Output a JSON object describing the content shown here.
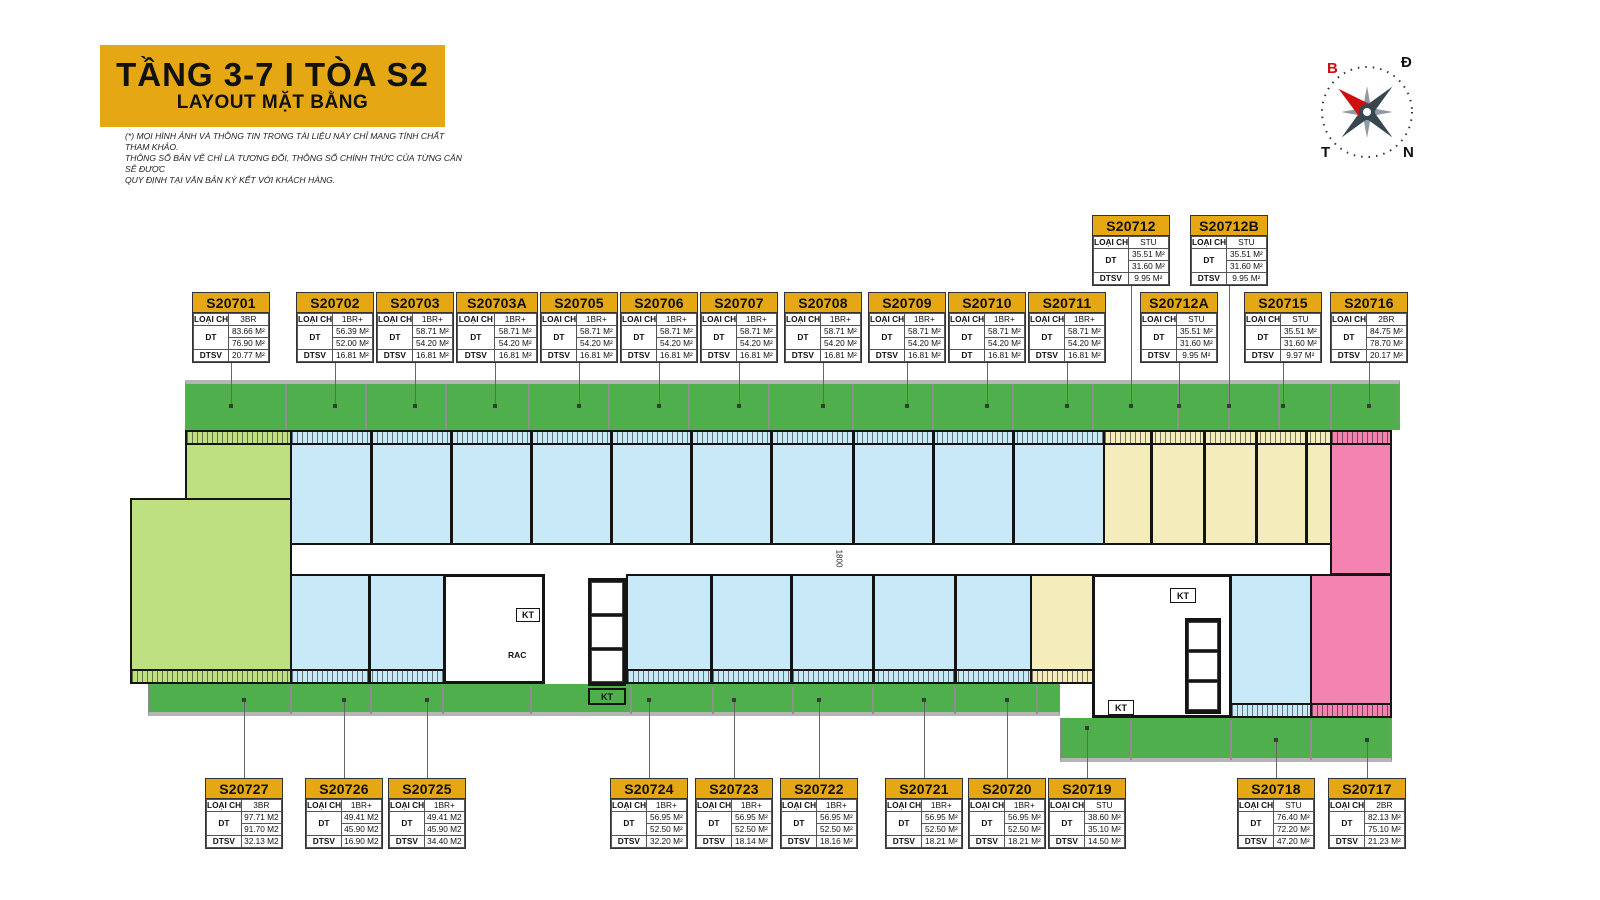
{
  "header": {
    "title_line1": "TẦNG  3-7  I  TÒA S2",
    "title_line2": "LAYOUT MẶT BẰNG",
    "disclaimer_lines": [
      "(*) MỌI HÌNH ẢNH VÀ THÔNG TIN TRONG TÀI LIỆU NÀY CHỈ MANG TÍNH  CHẤT THAM KHẢO.",
      "THÔNG SỐ BẢN VẼ CHỈ LÀ TƯƠNG ĐỐI, THÔNG SỐ CHÍNH THỨC CỦA TỪNG CĂN SẼ ĐƯỢC",
      "QUY ĐỊNH TẠI VĂN BẢN KÝ KẾT VỚI KHÁCH HÀNG."
    ]
  },
  "compass": {
    "north": "B",
    "east": "Đ",
    "west": "T",
    "south": "N"
  },
  "card_labels": {
    "type": "LOẠI CH",
    "area": "DT"
  },
  "units": [
    {
      "code": "S20701",
      "row": "top",
      "type": "3BR",
      "dt1": "83.66 M²",
      "dt2": "76.90 M²",
      "last_label": "DTSV",
      "last_value": "20.77 M²"
    },
    {
      "code": "S20702",
      "row": "top",
      "type": "1BR+",
      "dt1": "56.39 M²",
      "dt2": "52.00 M²",
      "last_label": "DTSV",
      "last_value": "16.81 M²"
    },
    {
      "code": "S20703",
      "row": "top",
      "type": "1BR+",
      "dt1": "58.71 M²",
      "dt2": "54.20 M²",
      "last_label": "DTSV",
      "last_value": "16.81 M²"
    },
    {
      "code": "S20703A",
      "row": "top",
      "type": "1BR+",
      "dt1": "58.71 M²",
      "dt2": "54.20 M²",
      "last_label": "DTSV",
      "last_value": "16.81 M²"
    },
    {
      "code": "S20705",
      "row": "top",
      "type": "1BR+",
      "dt1": "58.71 M²",
      "dt2": "54.20 M²",
      "last_label": "DTSV",
      "last_value": "16.81 M²"
    },
    {
      "code": "S20706",
      "row": "top",
      "type": "1BR+",
      "dt1": "58.71 M²",
      "dt2": "54.20 M²",
      "last_label": "DTSV",
      "last_value": "16.81 M²"
    },
    {
      "code": "S20707",
      "row": "top",
      "type": "1BR+",
      "dt1": "58.71 M²",
      "dt2": "54.20 M²",
      "last_label": "DTSV",
      "last_value": "16.81 M²"
    },
    {
      "code": "S20708",
      "row": "top",
      "type": "1BR+",
      "dt1": "58.71 M²",
      "dt2": "54.20 M²",
      "last_label": "DTSV",
      "last_value": "16.81 M²"
    },
    {
      "code": "S20709",
      "row": "top",
      "type": "1BR+",
      "dt1": "58.71 M²",
      "dt2": "54.20 M²",
      "last_label": "DTSV",
      "last_value": "16.81 M²"
    },
    {
      "code": "S20710",
      "row": "top",
      "type": "1BR+",
      "dt1": "58.71 M²",
      "dt2": "54.20 M²",
      "last_label": "DT",
      "last_value": "16.81 M²"
    },
    {
      "code": "S20711",
      "row": "top",
      "type": "1BR+",
      "dt1": "58.71 M²",
      "dt2": "54.20 M²",
      "last_label": "DTSV",
      "last_value": "16.81 M²"
    },
    {
      "code": "S20712",
      "row": "raised",
      "type": "STU",
      "dt1": "35.51 M²",
      "dt2": "31.60 M²",
      "last_label": "DTSV",
      "last_value": "9.95 M²"
    },
    {
      "code": "S20712B",
      "row": "raised",
      "type": "STU",
      "dt1": "35.51 M²",
      "dt2": "31.60 M²",
      "last_label": "DTSV",
      "last_value": "9.95 M²"
    },
    {
      "code": "S20712A",
      "row": "top",
      "type": "STU",
      "dt1": "35.51 M²",
      "dt2": "31.60 M²",
      "last_label": "DTSV",
      "last_value": "9.95 M²"
    },
    {
      "code": "S20715",
      "row": "top",
      "type": "STU",
      "dt1": "35.51 M²",
      "dt2": "31.60 M²",
      "last_label": "DTSV",
      "last_value": "9.97 M²"
    },
    {
      "code": "S20716",
      "row": "top",
      "type": "2BR",
      "dt1": "84.75 M²",
      "dt2": "78.70 M²",
      "last_label": "DTSV",
      "last_value": "20.17 M²"
    },
    {
      "code": "S20727",
      "row": "bottom",
      "type": "3BR",
      "dt1": "97.71 M2",
      "dt2": "91.70 M2",
      "last_label": "DTSV",
      "last_value": "32.13 M2"
    },
    {
      "code": "S20726",
      "row": "bottom",
      "type": "1BR+",
      "dt1": "49.41 M2",
      "dt2": "45.90 M2",
      "last_label": "DTSV",
      "last_value": "16.90 M2"
    },
    {
      "code": "S20725",
      "row": "bottom",
      "type": "1BR+",
      "dt1": "49.41 M2",
      "dt2": "45.90 M2",
      "last_label": "DTSV",
      "last_value": "34.40 M2"
    },
    {
      "code": "S20724",
      "row": "bottom",
      "type": "1BR+",
      "dt1": "56.95 M²",
      "dt2": "52.50 M²",
      "last_label": "DTSV",
      "last_value": "32.20 M²"
    },
    {
      "code": "S20723",
      "row": "bottom",
      "type": "1BR+",
      "dt1": "56.95 M²",
      "dt2": "52.50 M²",
      "last_label": "DTSV",
      "last_value": "18.14 M²"
    },
    {
      "code": "S20722",
      "row": "bottom",
      "type": "1BR+",
      "dt1": "56.95 M²",
      "dt2": "52.50 M²",
      "last_label": "DTSV",
      "last_value": "18.16 M²"
    },
    {
      "code": "S20721",
      "row": "bottom",
      "type": "1BR+",
      "dt1": "56.95 M²",
      "dt2": "52.50 M²",
      "last_label": "DTSV",
      "last_value": "18.21 M²"
    },
    {
      "code": "S20720",
      "row": "bottom",
      "type": "1BR+",
      "dt1": "56.95 M²",
      "dt2": "52.50 M²",
      "last_label": "DTSV",
      "last_value": "18.21 M²"
    },
    {
      "code": "S20719",
      "row": "bottom",
      "type": "STU",
      "dt1": "38.60 M²",
      "dt2": "35.10 M²",
      "last_label": "DTSV",
      "last_value": "14.50 M²"
    },
    {
      "code": "S20718",
      "row": "bottom",
      "type": "STU",
      "dt1": "76.40 M²",
      "dt2": "72.20 M²",
      "last_label": "DTSV",
      "last_value": "47.20 M²"
    },
    {
      "code": "S20717",
      "row": "bottom",
      "type": "2BR",
      "dt1": "82.13 M²",
      "dt2": "75.10 M²",
      "last_label": "DTSV",
      "last_value": "21.23 M²"
    }
  ],
  "plan": {
    "labels": {
      "kt": "KT",
      "rac": "RAC",
      "corridor_dim": "1800"
    },
    "colors": {
      "accent_yellow": "#e5a714",
      "balcony_green": "#4faf4d",
      "unit_green": "#bfe081",
      "unit_blue": "#c8e9f7",
      "unit_yellow": "#f5ecbb",
      "unit_pink": "#f583b2",
      "wall": "#141414"
    }
  }
}
